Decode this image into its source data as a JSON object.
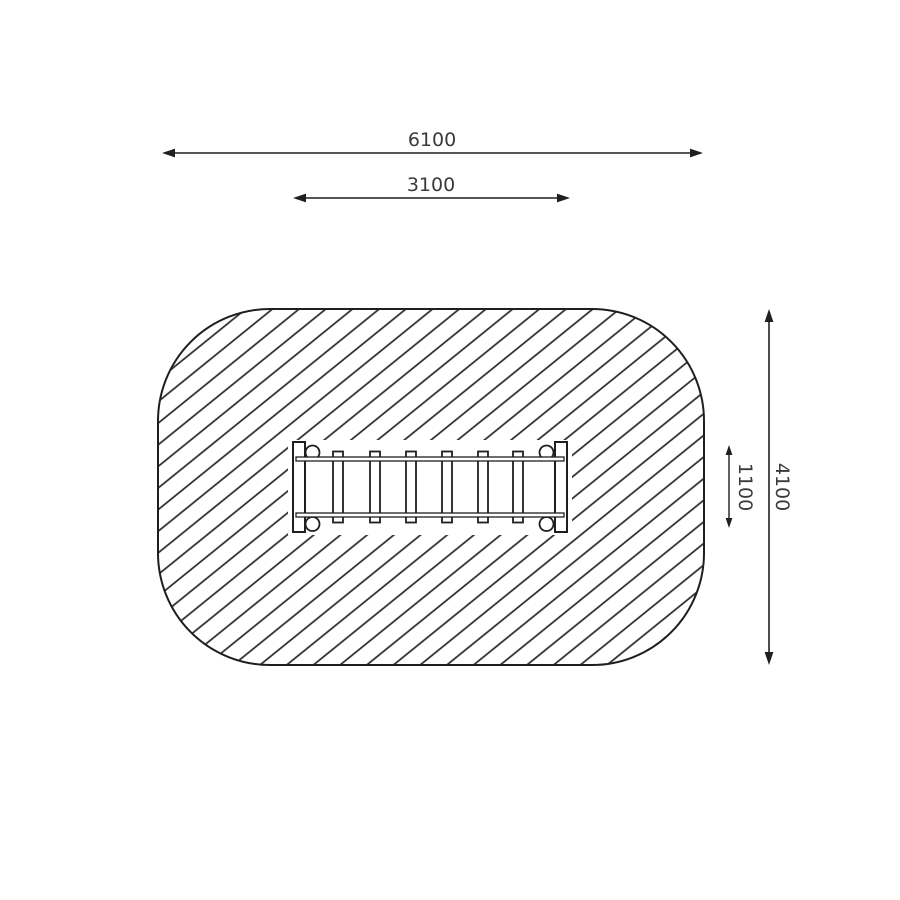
{
  "drawing": {
    "dimensions": {
      "overall_width": "6100",
      "inner_width": "3100",
      "overall_height": "4100",
      "inner_height": "1100"
    },
    "colors": {
      "line": "#1f1f1f",
      "dimension_text": "#3a3a3a",
      "background": "#ffffff"
    }
  }
}
